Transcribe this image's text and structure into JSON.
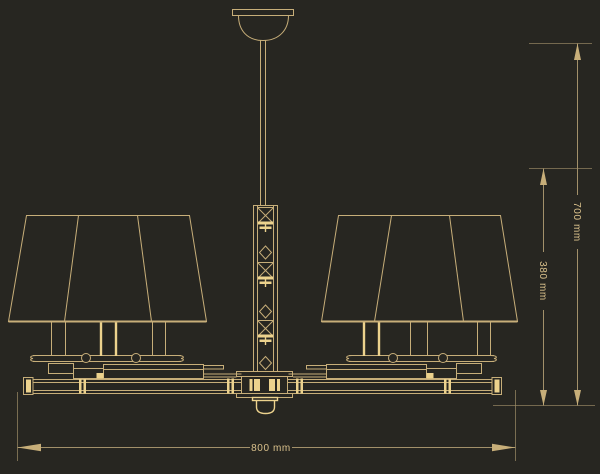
{
  "drawing": {
    "kind": "chandelier-elevation-technical-drawing"
  },
  "dimensions": {
    "width": {
      "label": "800 mm"
    },
    "height_overall": {
      "label": "700 mm"
    },
    "height_body": {
      "label": "380 mm"
    }
  },
  "colors": {
    "background": "#272621",
    "line": "#c7ae79",
    "bright": "#ecd28d",
    "dimline": "#a2906a",
    "text": "#d9c08b"
  }
}
